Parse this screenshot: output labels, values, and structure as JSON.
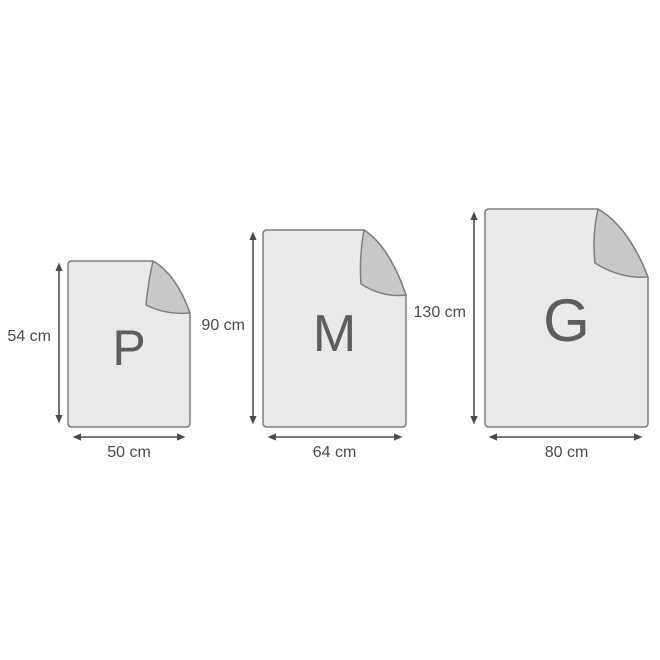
{
  "diagram": {
    "sizes": [
      {
        "letter": "P",
        "height_label": "54 cm",
        "width_label": "50 cm"
      },
      {
        "letter": "M",
        "height_label": "90 cm",
        "width_label": "64 cm"
      },
      {
        "letter": "G",
        "height_label": "130 cm",
        "width_label": "80 cm"
      }
    ],
    "colors": {
      "sheet_fill": "#e9e9e9",
      "sheet_border": "#7e7e7e",
      "fold_fill": "#c8c8c8",
      "arrow": "#4c4c4c",
      "label_text": "#494949",
      "letter_text": "#5d5d5d",
      "background": "#ffffff"
    }
  }
}
